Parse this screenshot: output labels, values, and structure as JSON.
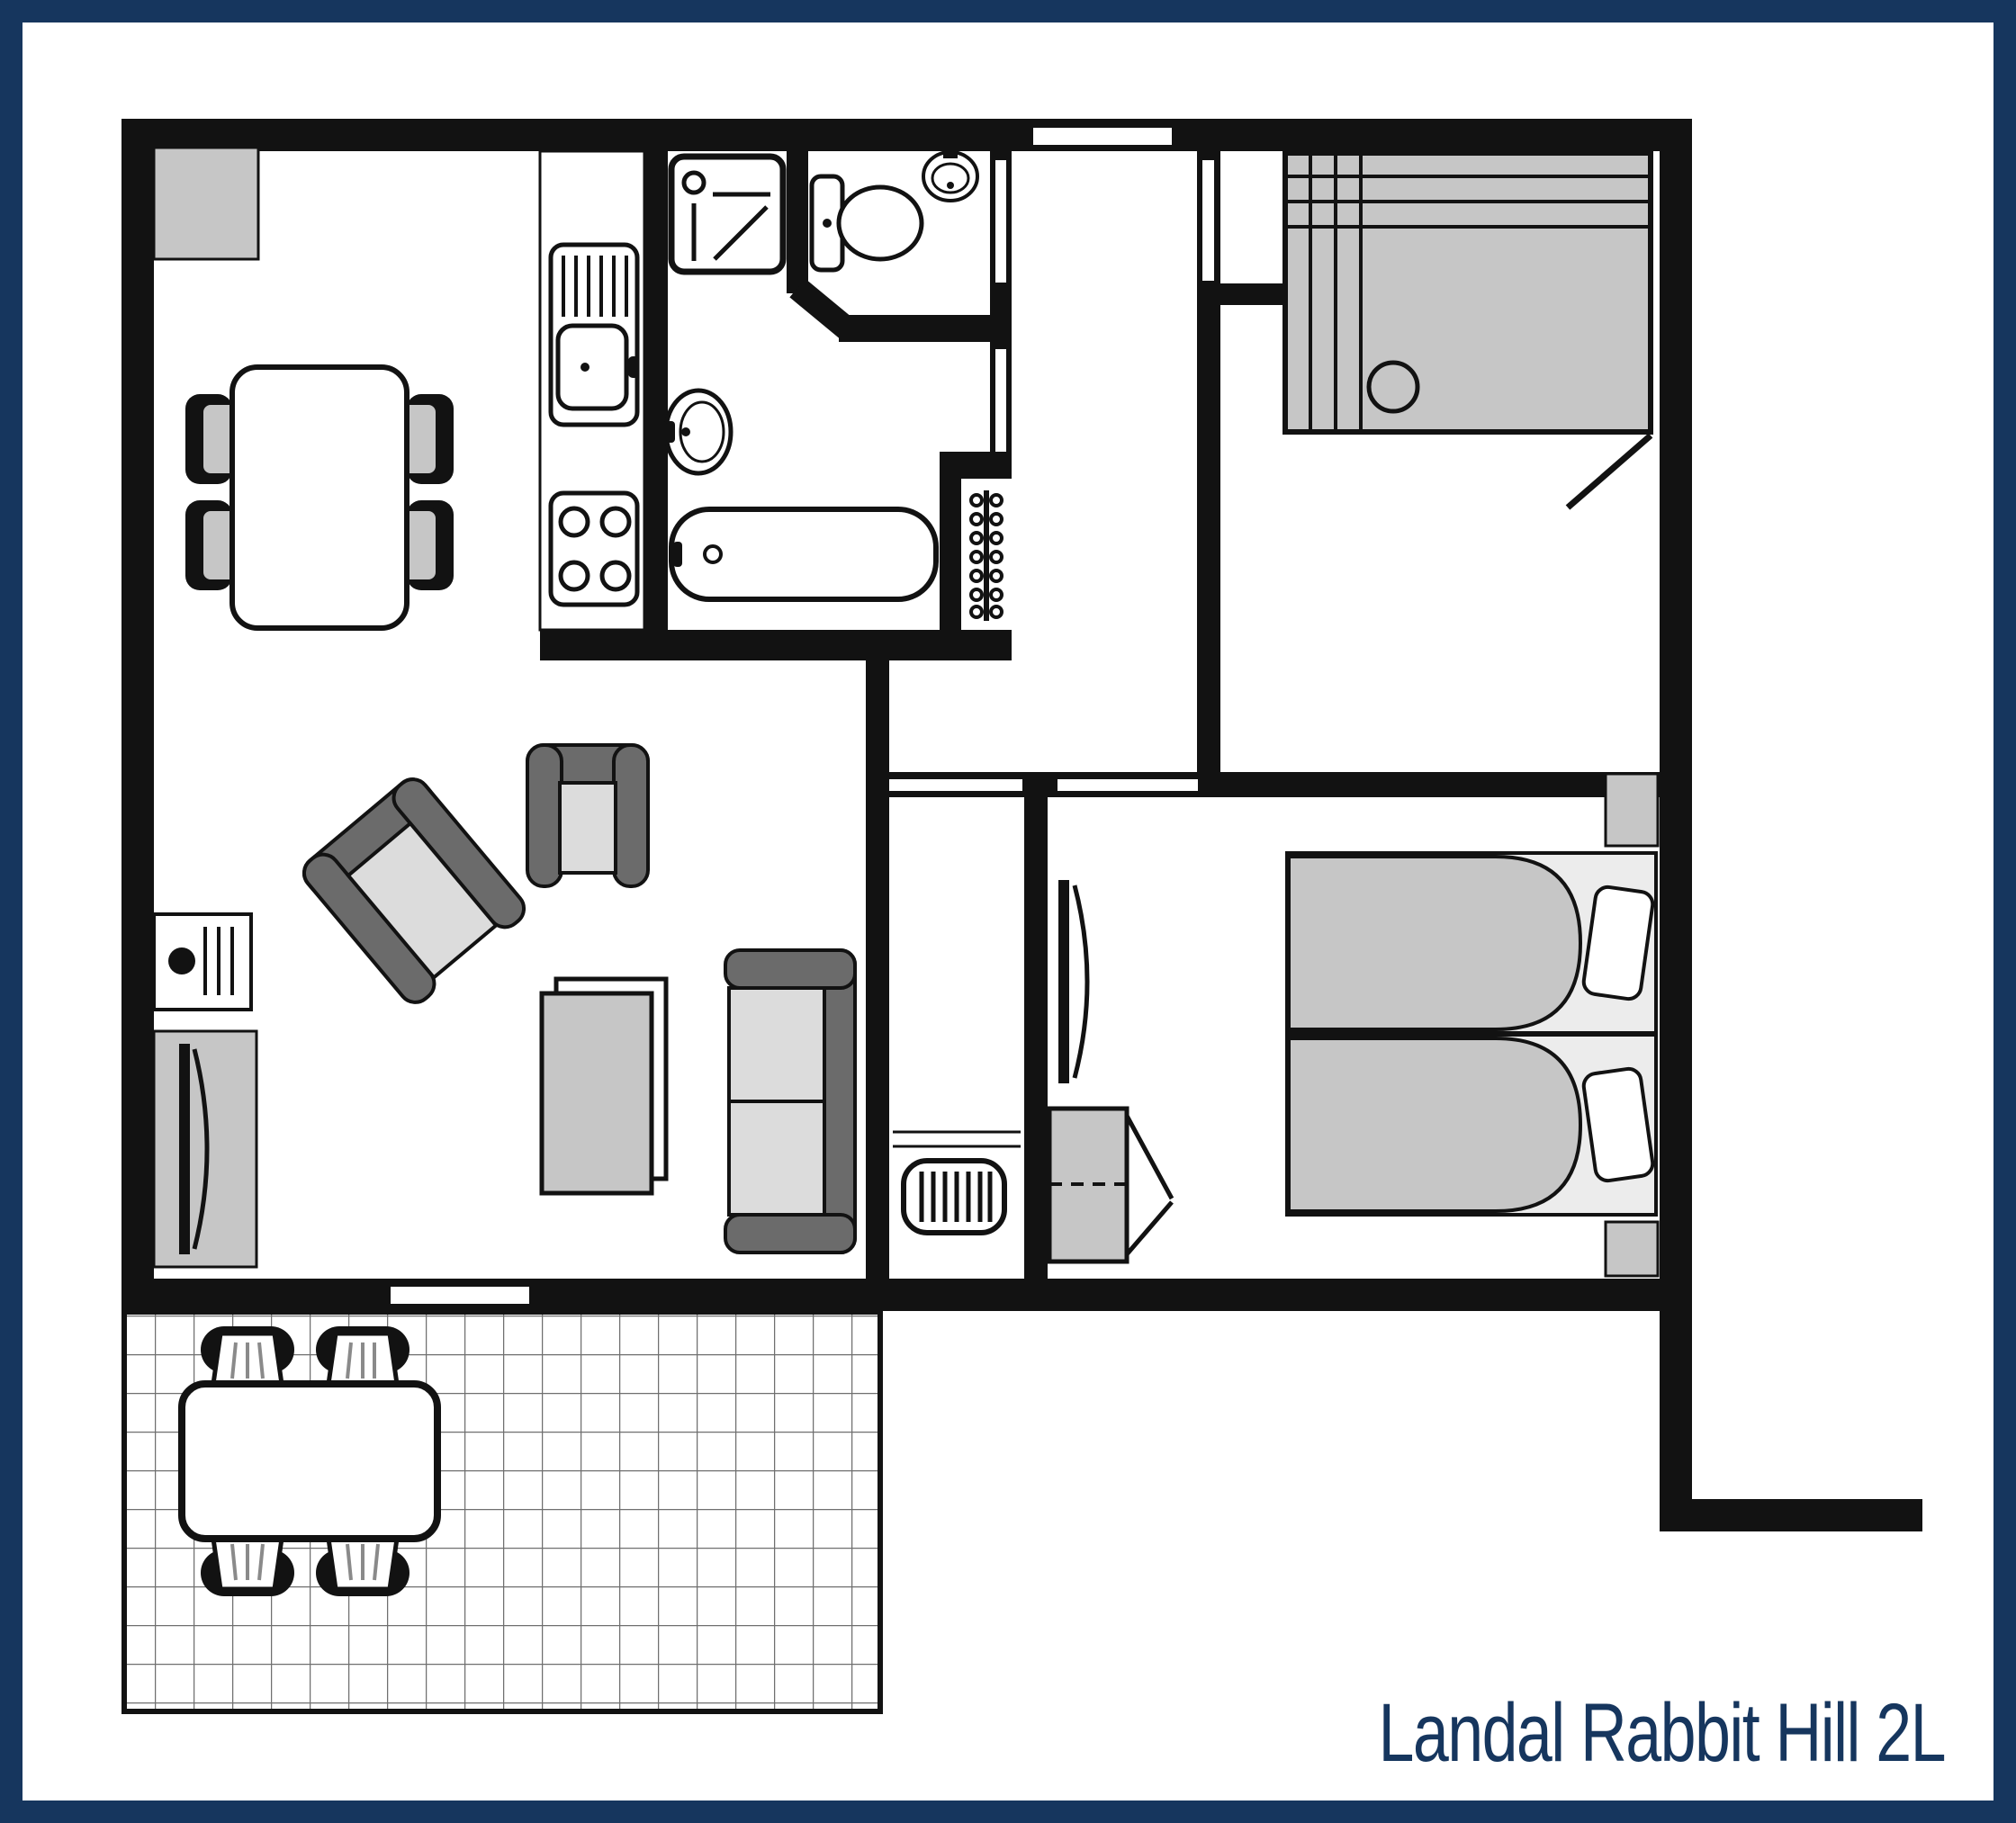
{
  "title": {
    "text": "Landal Rabbit Hill 2L"
  },
  "colors": {
    "frame": "#16365E",
    "title_text": "#16365E",
    "wall": "#121212",
    "gray": "#C6C6C6",
    "gray_dark": "#6B6B6B",
    "gray_light": "#DCDCDC",
    "grid_line": "#6F6F6F",
    "background": "#FFFFFF"
  }
}
